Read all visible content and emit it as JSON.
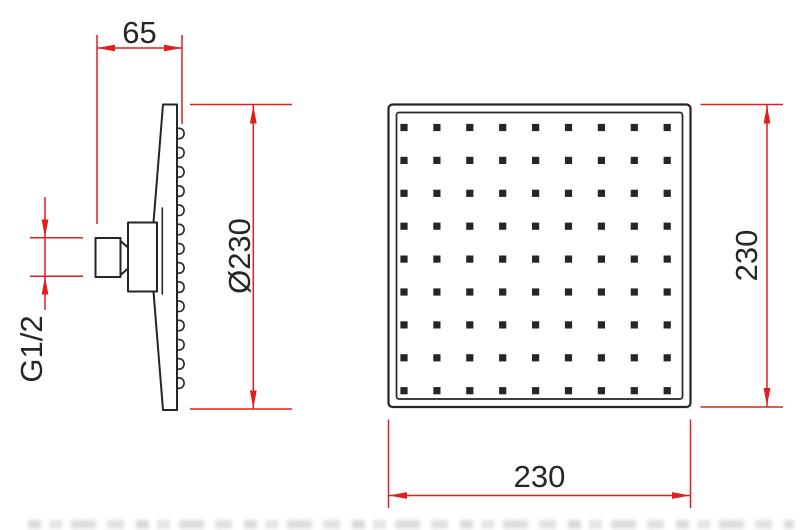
{
  "colors": {
    "line": "#262626",
    "dimension": "#e01e1e",
    "background": "#ffffff"
  },
  "side_view": {
    "depth_dimension": "65",
    "diameter_dimension": "Ø230",
    "thread_dimension": "G1/2",
    "nozzle_bump_count": 14
  },
  "front_view": {
    "width_dimension": "230",
    "height_dimension": "230",
    "nozzle_grid": {
      "rows": 9,
      "cols": 9
    }
  }
}
